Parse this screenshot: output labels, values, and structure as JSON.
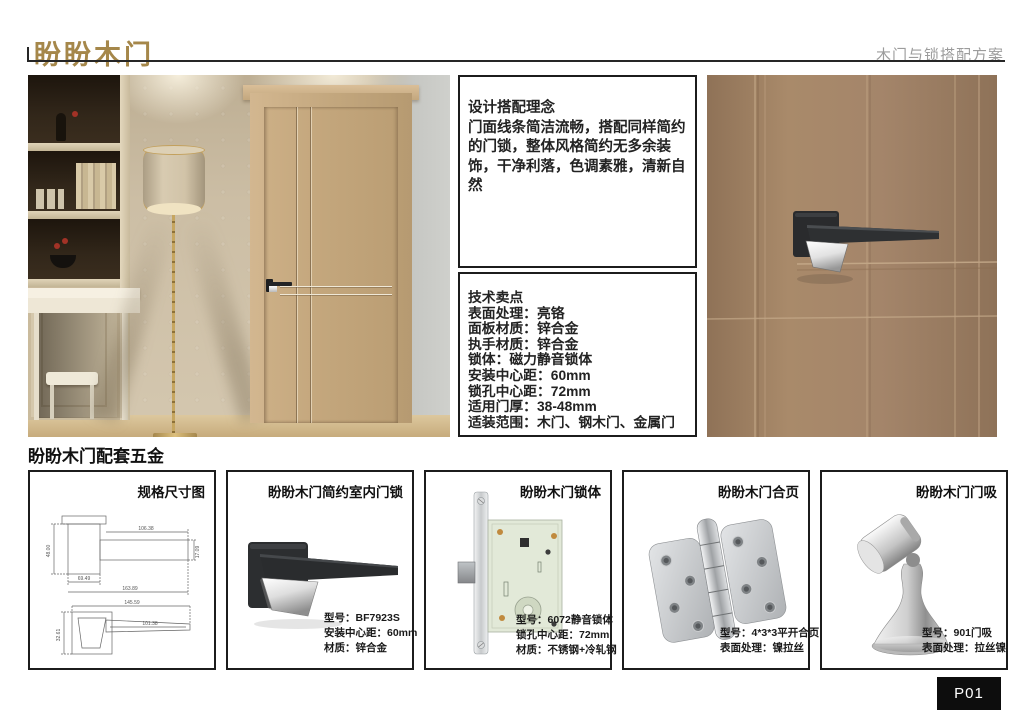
{
  "header": {
    "logo": "盼盼木门",
    "subtitle": "木门与锁搭配方案"
  },
  "colors": {
    "brand_gold": "#a5874a",
    "rule_black": "#262626",
    "door_brown": "#a4856a",
    "page_bg": "#ffffff"
  },
  "concept_box": {
    "title": "设计搭配理念",
    "body": "门面线条简洁流畅，搭配同样简约的门锁，整体风格简约无多余装饰，干净利落，色调素雅，清新自然"
  },
  "tech_box": {
    "title": "技术卖点",
    "lines": [
      "表面处理：亮铬",
      "面板材质：锌合金",
      "执手材质：锌合金",
      "锁体：磁力静音锁体",
      "安装中心距：60mm",
      "锁孔中心距：72mm",
      "适用门厚：38-48mm",
      "适装范围：木门、钢木门、金属门"
    ]
  },
  "section_title": "盼盼木门配套五金",
  "hardware": {
    "boxes": [
      {
        "title": "规格尺寸图",
        "specs": []
      },
      {
        "title": "盼盼木门简约室内门锁",
        "specs": [
          "型号：BF7923S",
          "安装中心距：60mm",
          "材质：锌合金"
        ]
      },
      {
        "title": "盼盼木门锁体",
        "specs": [
          "型号：6072静音锁体",
          "锁孔中心距：72mm",
          "材质：不锈钢+冷轧钢"
        ]
      },
      {
        "title": "盼盼木门合页",
        "specs": [
          "型号：4*3*3平开合页",
          "表面处理：镍拉丝"
        ]
      },
      {
        "title": "盼盼木门门吸",
        "specs": [
          "型号：901门吸",
          "表面处理：拉丝镍"
        ]
      }
    ]
  },
  "drawing": {
    "dims": {
      "rosette_h": "48.00",
      "lever_len": "106.38",
      "lever_h": "17.09",
      "rosette_w": "69.49",
      "total_len": "163.89",
      "bottom_total": "145.59",
      "bottom_lever": "101.38",
      "bottom_h": "32.61"
    }
  },
  "page_number": "P01"
}
